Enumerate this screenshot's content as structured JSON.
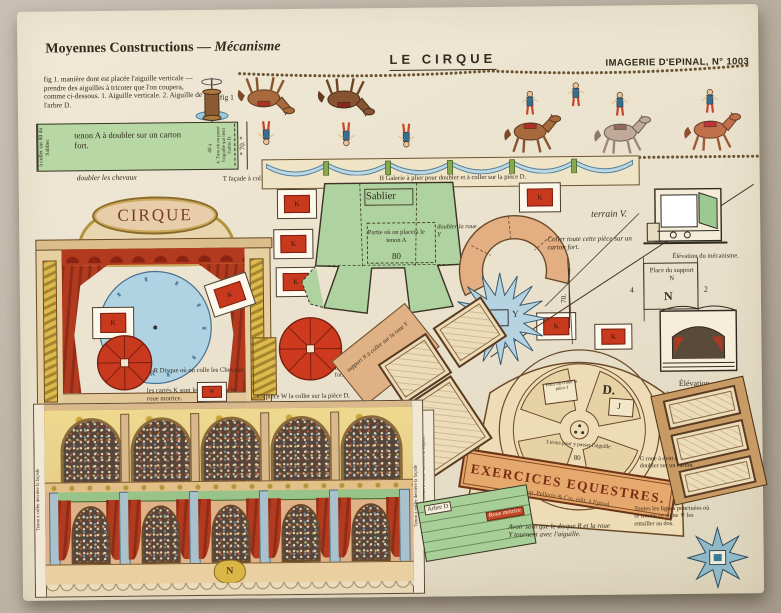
{
  "palette": {
    "sheet": "#e9e2cf",
    "green": "#b7d8a5",
    "red": "#c8391e",
    "blue_disc": "#afd3e3",
    "tan": "#e2ae82",
    "cream": "#eedcb6",
    "curtain": "#b23a1f",
    "gold": "#d8b84a",
    "star_blue": "#b6d3e1"
  },
  "header": {
    "series": "Moyennes Constructions",
    "series_em": "— Mécanisme",
    "title": "LE CIRQUE",
    "publisher": "IMAGERIE D'EPINAL, N° 1003"
  },
  "fig1": {
    "text": "fig 1. manière dont est placée l'aiguille verticale — prendre des aiguilles à tricoter que l'on coupera, comme ci-dessous. 1. Aiguille verticale. 2. Aiguille de l'arbre D.",
    "label": "fig 1"
  },
  "strip": {
    "left": "à coller sur 80 du Sablier.",
    "main": "tenon A à doubler sur un carton fort.",
    "num": "40 a",
    "right": "4. Trou où on passe l'aiguille qui tient l'arbre D.",
    "dim": "* 70. *",
    "below": "doubler les chevaux"
  },
  "facade": {
    "title": "CIRQUE",
    "r": "R",
    "note": "T façade à coller sur la pièce D."
  },
  "galerie_note": "H Galerie à plier pour doubler et à coller sur la pièce D.",
  "k": "K",
  "w": "W",
  "sablier": {
    "title": "Sablier",
    "inner": "Partie où on placera le tenon A",
    "num": "80"
  },
  "notes": {
    "r_disque": "R Disque où on colle les Chevaux.",
    "carres": "les carrés K sont les palettes de la roue motrice.",
    "rondelles": "LL rondelles pour former la roue motrice.",
    "piece_w": "La pièce W la coller sur la pièce D.",
    "doubler_roue": "doubler la roue Y",
    "terrain": "terrain V.",
    "carton": "Coller toute cette pièce sur un carton fort.",
    "support_piece": "support N à coller sur la roue Y",
    "z_tenon": "Z tenon du support",
    "coller_s": "coller S sur 3 de la pièce D.",
    "g_roue": "G roue à dent à doubler sur un carton.",
    "pointillees": "Toutes les lignes ponctuées où se trouve ce signe ✳ les entailler au dos.",
    "soin": "Avoir soin que le disque R et la roue Y tournent avec l'aiguille.",
    "tenon_facade": "Tenon à coller derrière la façade"
  },
  "roue_y": {
    "label": "Roue Y",
    "letter": "Y"
  },
  "elev": {
    "mecanisme": "Élévation du mécanisme.",
    "place": "Place du support N",
    "n": "N",
    "n4": "4",
    "n2": "2",
    "n3": "3",
    "elevation": "Élévation."
  },
  "wheel": {
    "d": "D.",
    "j": "J",
    "place_j": "Place où coller la pièce J",
    "trous": "3 trous pour y passer l'aiguille",
    "num": "80"
  },
  "banner": "EXERCICES EQUESTRES.",
  "imprint": "Imp. Pellerin & Cie, édit. à Epinal.",
  "arbre": {
    "a": "Arbre D",
    "b": "Roue motrice"
  },
  "dims": {
    "d70": "70."
  }
}
